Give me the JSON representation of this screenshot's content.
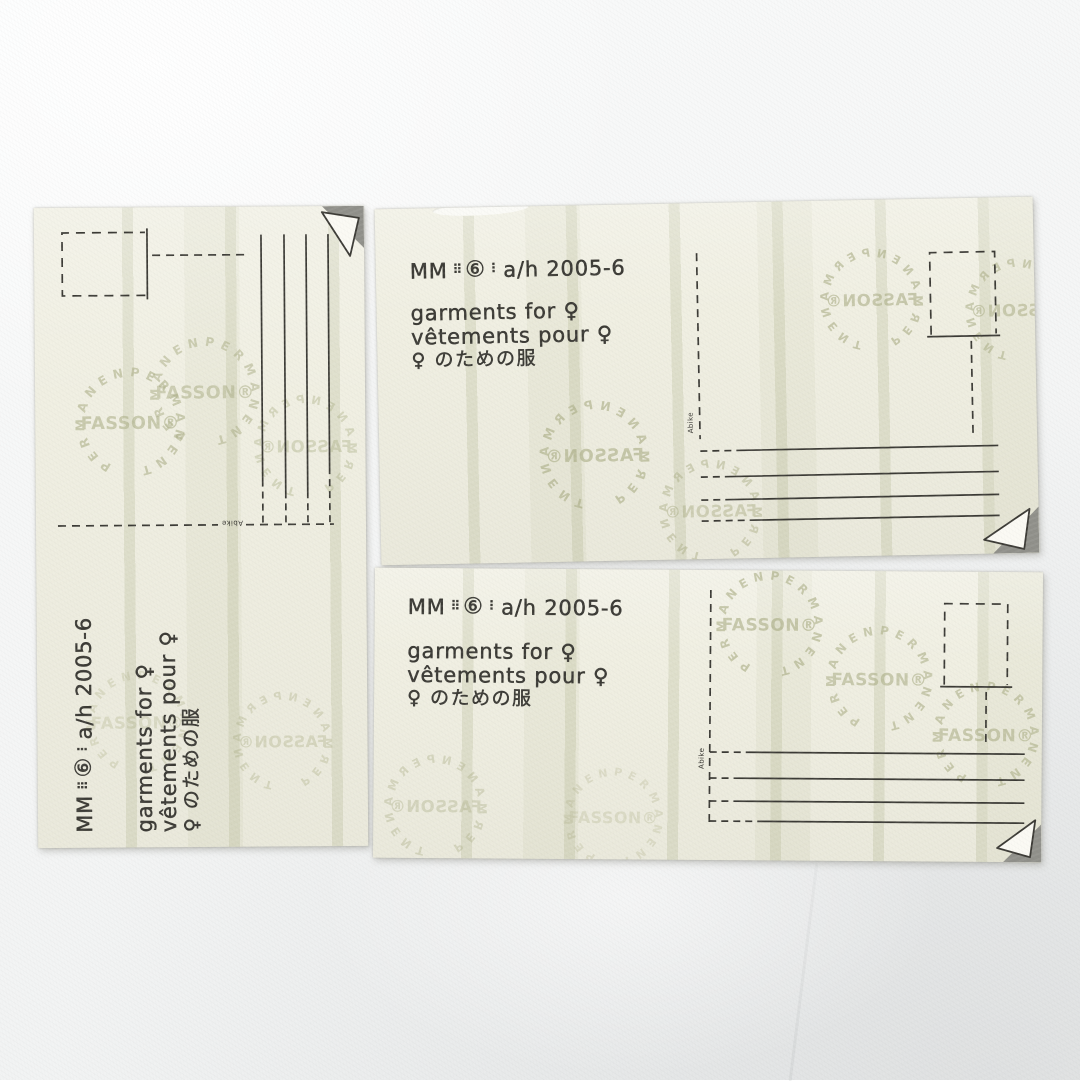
{
  "labels": {
    "brand": {
      "mm": "MM",
      "dots_a": "⠿",
      "circled_six": "⑥",
      "dots_b": "⠇",
      "season": "a/h 2005-6"
    },
    "lines": {
      "en": "garments for ♀",
      "fr": "vêtements pour ♀",
      "jp": "♀ のための服"
    },
    "micro_text": "Abike",
    "watermark": {
      "name": "FASSON®",
      "ring": "PERMANENT"
    }
  },
  "colors": {
    "paper": "#f0efe2",
    "ink": "#3b3a35",
    "watermark": "#abae86",
    "stripe": "#dcdec9",
    "leather": "#f5f6f6",
    "fold_shadow": "#90908a"
  }
}
